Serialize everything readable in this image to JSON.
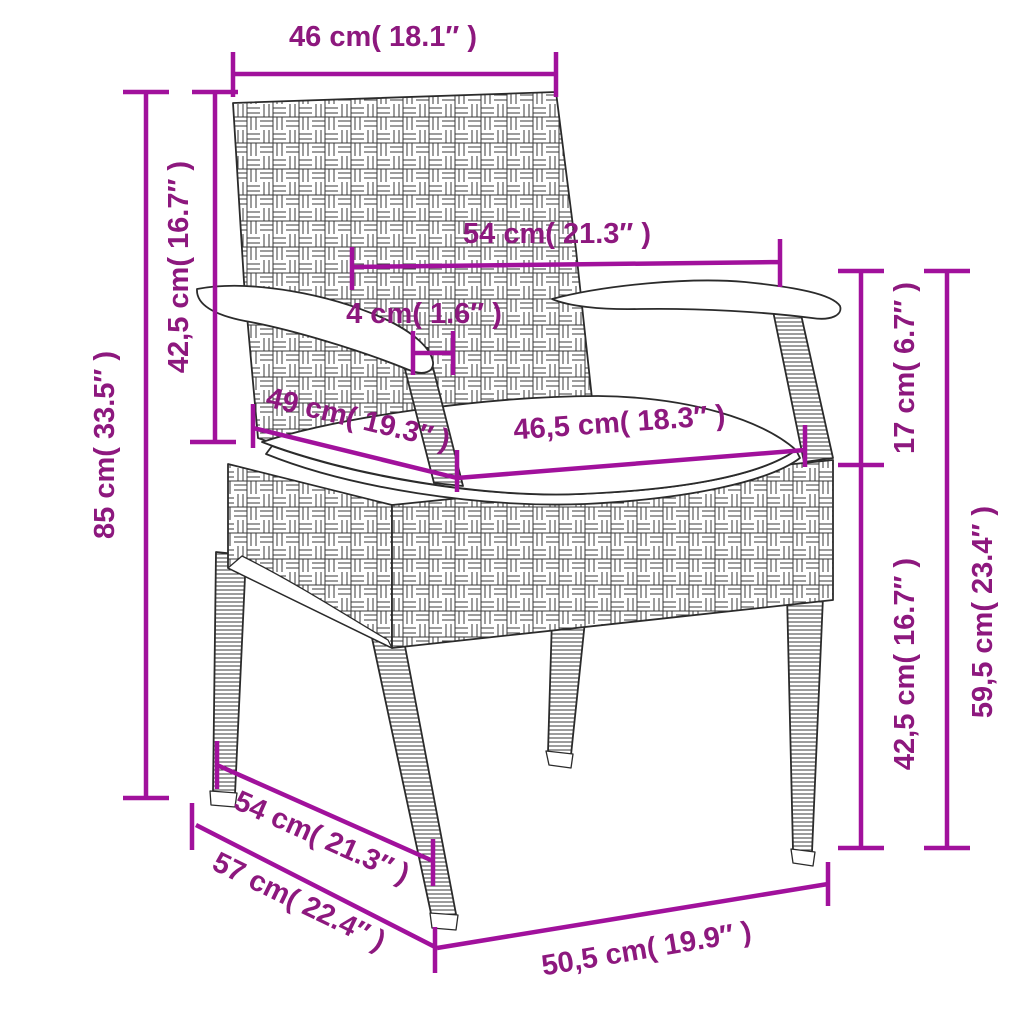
{
  "diagram": {
    "subject": "poly-rattan garden chair with cushion",
    "style": "line-art dimension drawing",
    "colors": {
      "dimension_line": "#A1119C",
      "dimension_text": "#8D187E",
      "line_art": "#2B2B2B",
      "background": "#FFFFFF"
    }
  },
  "measurements": {
    "backrest_width": {
      "label": "46 cm( 18.1″ )",
      "cm": "46",
      "inches": "18.1"
    },
    "armrest_span": {
      "label": "54 cm( 21.3″ )",
      "cm": "54",
      "inches": "21.3"
    },
    "strut_width": {
      "label": "4 cm( 1.6″ )",
      "cm": "4",
      "inches": "1.6"
    },
    "seat_depth": {
      "label": "49 cm( 19.3″ )",
      "cm": "49",
      "inches": "19.3"
    },
    "seat_width": {
      "label": "46,5 cm( 18.3″ )",
      "cm": "46,5",
      "inches": "18.3"
    },
    "backrest_height": {
      "label": "42,5 cm( 16.7″ )",
      "cm": "42,5",
      "inches": "16.7"
    },
    "total_height": {
      "label": "85 cm( 33.5″ )",
      "cm": "85",
      "inches": "33.5"
    },
    "armrest_above_seat": {
      "label": "17 cm( 6.7″ )",
      "cm": "17",
      "inches": "6.7"
    },
    "seat_height": {
      "label": "42,5 cm( 16.7″ )",
      "cm": "42,5",
      "inches": "16.7"
    },
    "armrest_floor_height": {
      "label": "59,5 cm( 23.4″ )",
      "cm": "59,5",
      "inches": "23.4"
    },
    "depth_upper": {
      "label": "54 cm( 21.3″ )",
      "cm": "54",
      "inches": "21.3"
    },
    "depth_total": {
      "label": "57 cm( 22.4″ )",
      "cm": "57",
      "inches": "22.4"
    },
    "front_width": {
      "label": "50,5 cm( 19.9″ )",
      "cm": "50,5",
      "inches": "19.9"
    }
  }
}
